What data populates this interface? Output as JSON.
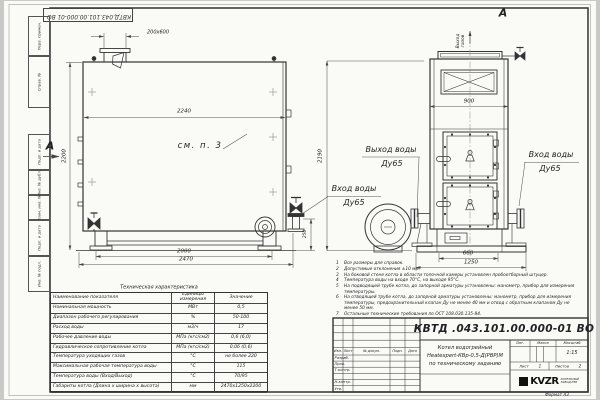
{
  "sheet": {
    "designation": "КВТД.043.101.00.000-01  ВО",
    "format_label": "Формат А3"
  },
  "margin": {
    "cells": [
      {
        "label": "Перв. примен."
      },
      {
        "label": "Справ. №"
      },
      {
        "label": "Подп. и дата"
      },
      {
        "label": "Инв. № дубл."
      },
      {
        "label": "Взам. инв. №"
      },
      {
        "label": "Подп. и дата"
      },
      {
        "label": "Инв. № подл."
      }
    ]
  },
  "drawing": {
    "view_label": "А",
    "see_ref": "см. п. 3",
    "gas_out_l1": "Выход",
    "gas_out_l2": "газов",
    "water_out_l1": "Выход воды",
    "water_out_l2": "Ду65",
    "water_in_l1": "Вход воды",
    "water_in_l2": "Ду65",
    "dims": {
      "flue": "200x600",
      "top_width": "2240",
      "left_height": "2200",
      "support_span": "2000",
      "overall_length": "2470",
      "valve_height": "250",
      "front_height": "2190",
      "front_width": "900",
      "front_support_span": "660",
      "front_overall_width": "1250"
    }
  },
  "table": {
    "title": "Техническая характеристика",
    "headers": {
      "name": "Наименование показателя",
      "unit": "Единицы измерения",
      "value": "Значение"
    },
    "rows": [
      {
        "name": "Номинальная мощность",
        "unit": "МВт",
        "value": "0,5"
      },
      {
        "name": "Диапазон рабочего регулирования",
        "unit": "%",
        "value": "50-100"
      },
      {
        "name": "Расход воды",
        "unit": "м3/ч",
        "value": "17"
      },
      {
        "name": "Рабочее давление воды",
        "unit": "МПа (кгс/см2)",
        "value": "0,6 (6,0)"
      },
      {
        "name": "Гидравлическое сопротивление котла",
        "unit": "МПа (кгс/см2)",
        "value": "0,06 (0,6)"
      },
      {
        "name": "Температура уходящих газов",
        "unit": "°С",
        "value": "не более 220"
      },
      {
        "name": "Максимальная рабочая температура воды",
        "unit": "°С",
        "value": "115"
      },
      {
        "name": "Температура воды (Вход/Выход)",
        "unit": "°С",
        "value": "70/95"
      },
      {
        "name": "Габариты котла (Длина х ширина х высота)",
        "unit": "мм",
        "value": "2470х1250х2200"
      }
    ]
  },
  "notes": [
    {
      "n": "1",
      "text": "Все размеры для справок."
    },
    {
      "n": "2",
      "text": "Допустимые отклонения ±10 мм."
    },
    {
      "n": "3",
      "text": "На боковой стене котла в области топочной камеры установлен пробоотборный штуцер."
    },
    {
      "n": "4",
      "text": "Температура воды на входе 70°С, на выходе 95°С."
    },
    {
      "n": "5",
      "text": "На подводящей трубе котла, до запорной арматуры установлены: манометр, прибор для измерения температуры."
    },
    {
      "n": "6",
      "text": "На отводящей трубе котла, до запорной арматуры установлены: манометр, прибор для измерения температуры, предохранительный клапан Ду не менее 40 мм и отвод с обратным клапаном Ду не менее 50 мм."
    },
    {
      "n": "7",
      "text": "Остальные технические требования по ОСТ 108.030.135-84."
    }
  ],
  "title_block": {
    "designation": "КВТД .043.101.00.000-01  ВО",
    "product_l1": "Котел водогрейный",
    "product_l2": "Heatexpert-КВр-0,5-Д(РВР)М",
    "product_l3": "по техническому заданию",
    "cols": {
      "izm": "Изм.",
      "list": "Лист",
      "doc": "№ докум.",
      "sign": "Подп.",
      "date": "Дата"
    },
    "roles": [
      "Разраб.",
      "Пров.",
      "Т.контр.",
      "",
      "Н.контр.",
      "Утв."
    ],
    "lit": "Лит.",
    "mass": "Масса",
    "scale_label": "Масштаб",
    "scale": "1:15",
    "sheet_label": "Лист",
    "sheet_no": "1",
    "sheets_label": "Листов",
    "sheets_no": "2",
    "logo_text": "KVZR",
    "logo_sub1": "КОТЕЛЬНЫЙ",
    "logo_sub2": "ЗАВОД РЭП"
  }
}
